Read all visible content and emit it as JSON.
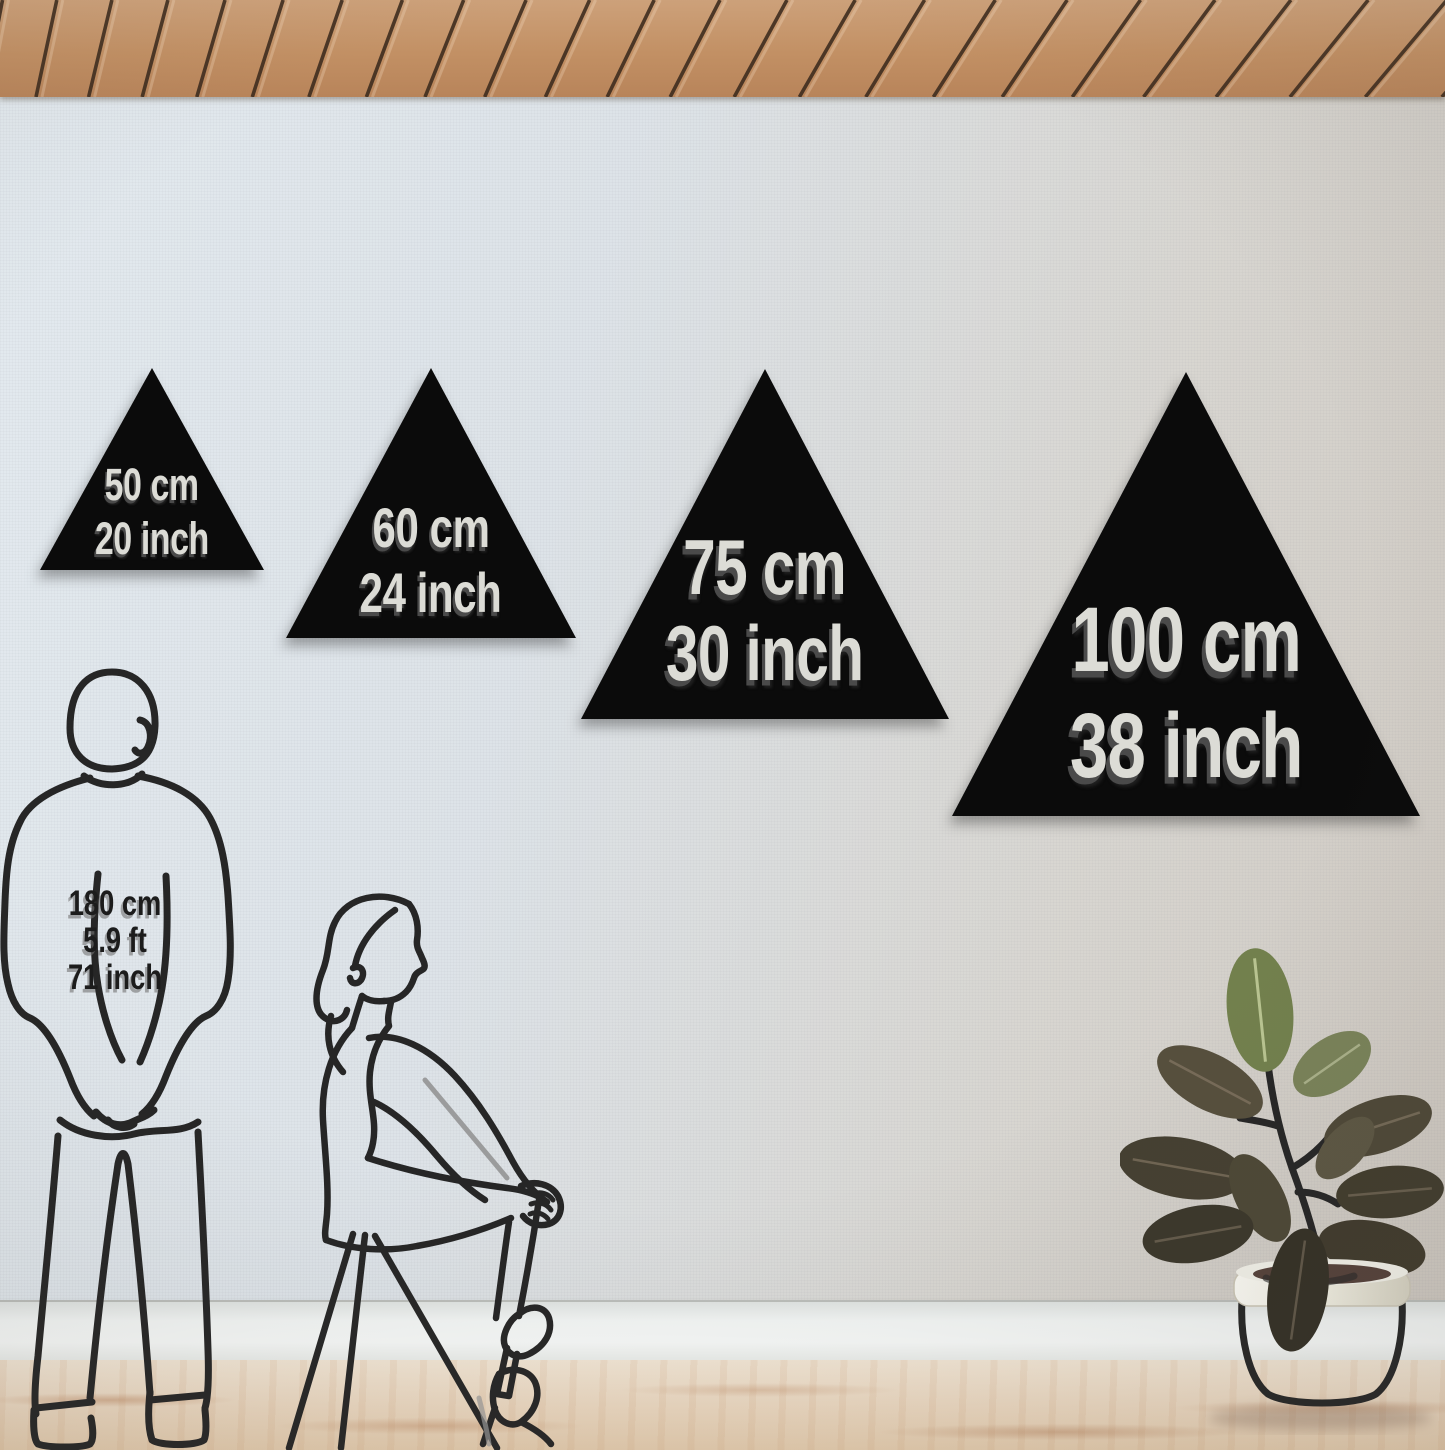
{
  "size_guide": {
    "triangles": [
      {
        "cm_label": "50 cm",
        "inch_label": "20 inch"
      },
      {
        "cm_label": "60 cm",
        "inch_label": "24 inch"
      },
      {
        "cm_label": "75 cm",
        "inch_label": "30 inch"
      },
      {
        "cm_label": "100 cm",
        "inch_label": "38 inch"
      }
    ],
    "reference_person": {
      "height_cm": "180 cm",
      "height_ft": "5.9 ft",
      "height_inch": "71 inch"
    }
  },
  "colors": {
    "triangle_fill": "#0b0b0b",
    "triangle_label_text": "#dcdcd6",
    "triangle_label_shadow": "#4a4a4a",
    "person_label_text": "#1c1c1c",
    "wall": "#dce2e7",
    "ceiling_wood": "#c49571",
    "ceiling_slat_gap": "#3f2d1f",
    "floor_wood": "#ecdac5",
    "baseboard": "#f3f5f4",
    "line_art": "#262626",
    "plant_pot": "#efeee6",
    "plant_leaf_green": "#72804d"
  }
}
